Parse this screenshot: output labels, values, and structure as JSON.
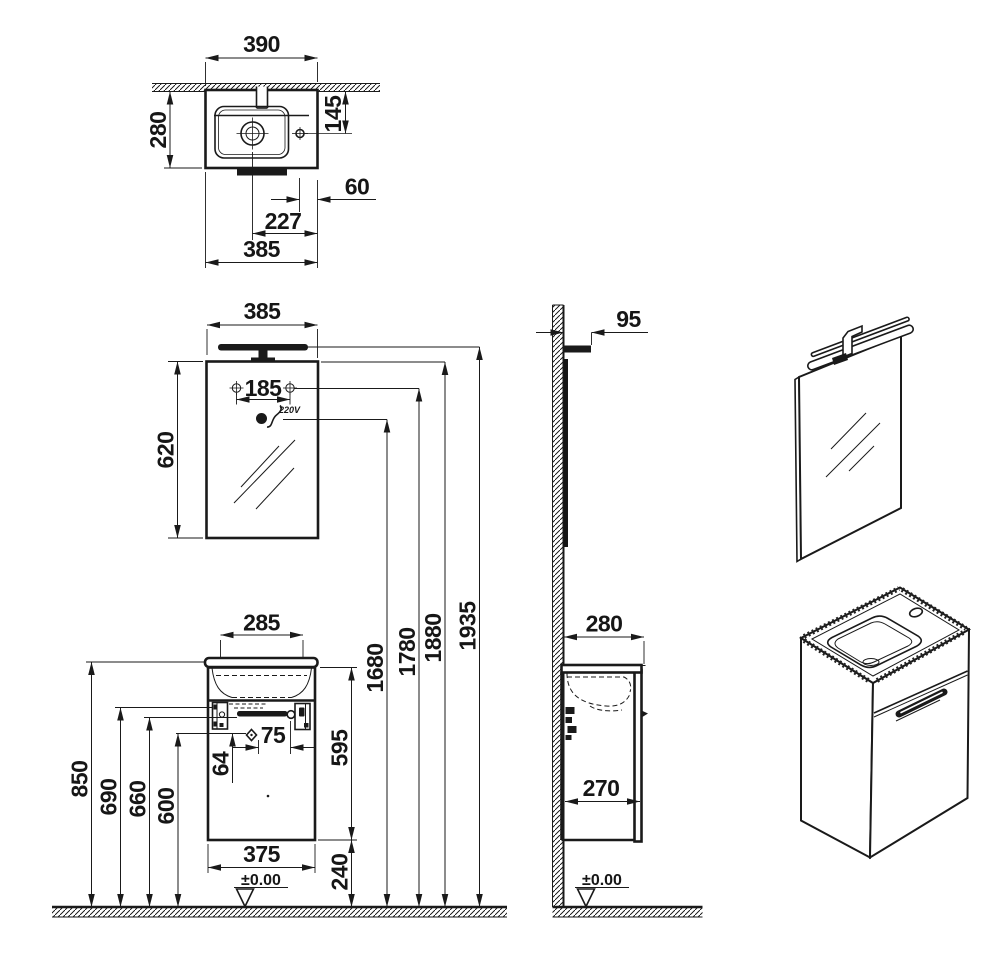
{
  "drawing": {
    "type": "bathroom-vanity-mirror-installation-drawing",
    "colors": {
      "line": "#1a1a1a",
      "background": "#ffffff"
    },
    "top_view": {
      "width_overall": "390",
      "depth": "280",
      "tap_from_wall": "145",
      "tap_to_edge": "60",
      "drain_to_edge": "227",
      "width_body": "385"
    },
    "mirror_view": {
      "width": "385",
      "height": "620",
      "fixing_centers": "185",
      "outlet_label": "220V"
    },
    "vanity_view": {
      "basin_width": "285",
      "worktop_height": "850",
      "hinge_height": "690",
      "handle_height": "660",
      "ref_height": "600",
      "hinge_offset": "64",
      "handle_centers": "75",
      "cabinet_height": "595",
      "cabinet_width": "375",
      "floor_clearance": "240",
      "datum": "±0.00"
    },
    "elevation": {
      "outlet_height": "1680",
      "fixing_height": "1780",
      "mirror_top_height": "1880",
      "light_height": "1935"
    },
    "side_view": {
      "light_depth": "95",
      "depth_overall": "280",
      "cabinet_depth": "270",
      "datum": "±0.00"
    },
    "symbols": {
      "drain": "concentric-circle-crosshair",
      "tap_hole": "circle-crosshair",
      "mirror_fixing": "screw-crosshair",
      "power_outlet": "socket-with-cable",
      "handle_fixing": "diamond-marker",
      "datum": "inverted-triangle"
    }
  }
}
